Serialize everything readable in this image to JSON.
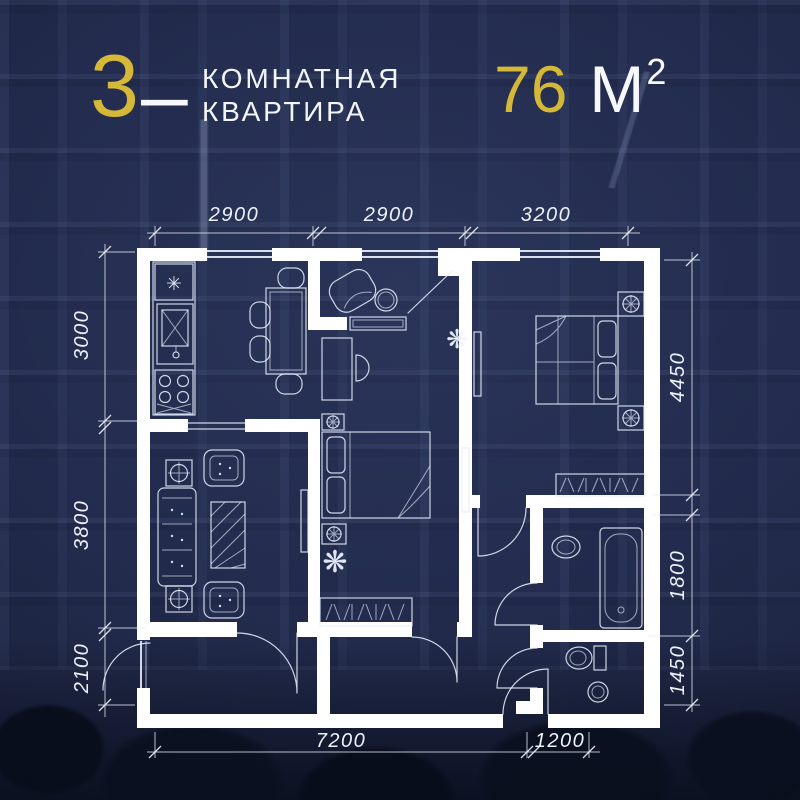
{
  "header": {
    "rooms": "3",
    "dash": "–",
    "title_line1": "КОМНАТНАЯ",
    "title_line2": "КВАРТИРА",
    "area_value": "76",
    "area_unit": "М",
    "area_superscript": "2"
  },
  "plan": {
    "dim_top": [
      "2900",
      "2900",
      "3200"
    ],
    "dim_left": [
      "3000",
      "3800",
      "2100"
    ],
    "dim_right": [
      "4450",
      "1800",
      "1450"
    ],
    "dim_bottom": [
      "7200",
      "1200"
    ]
  },
  "symbols": {
    "fridge_symbol": "✳",
    "plant_symbol": "❋"
  },
  "colors": {
    "background": "#242d4f",
    "gold": "#d5b838",
    "wall": "#ffffff"
  }
}
